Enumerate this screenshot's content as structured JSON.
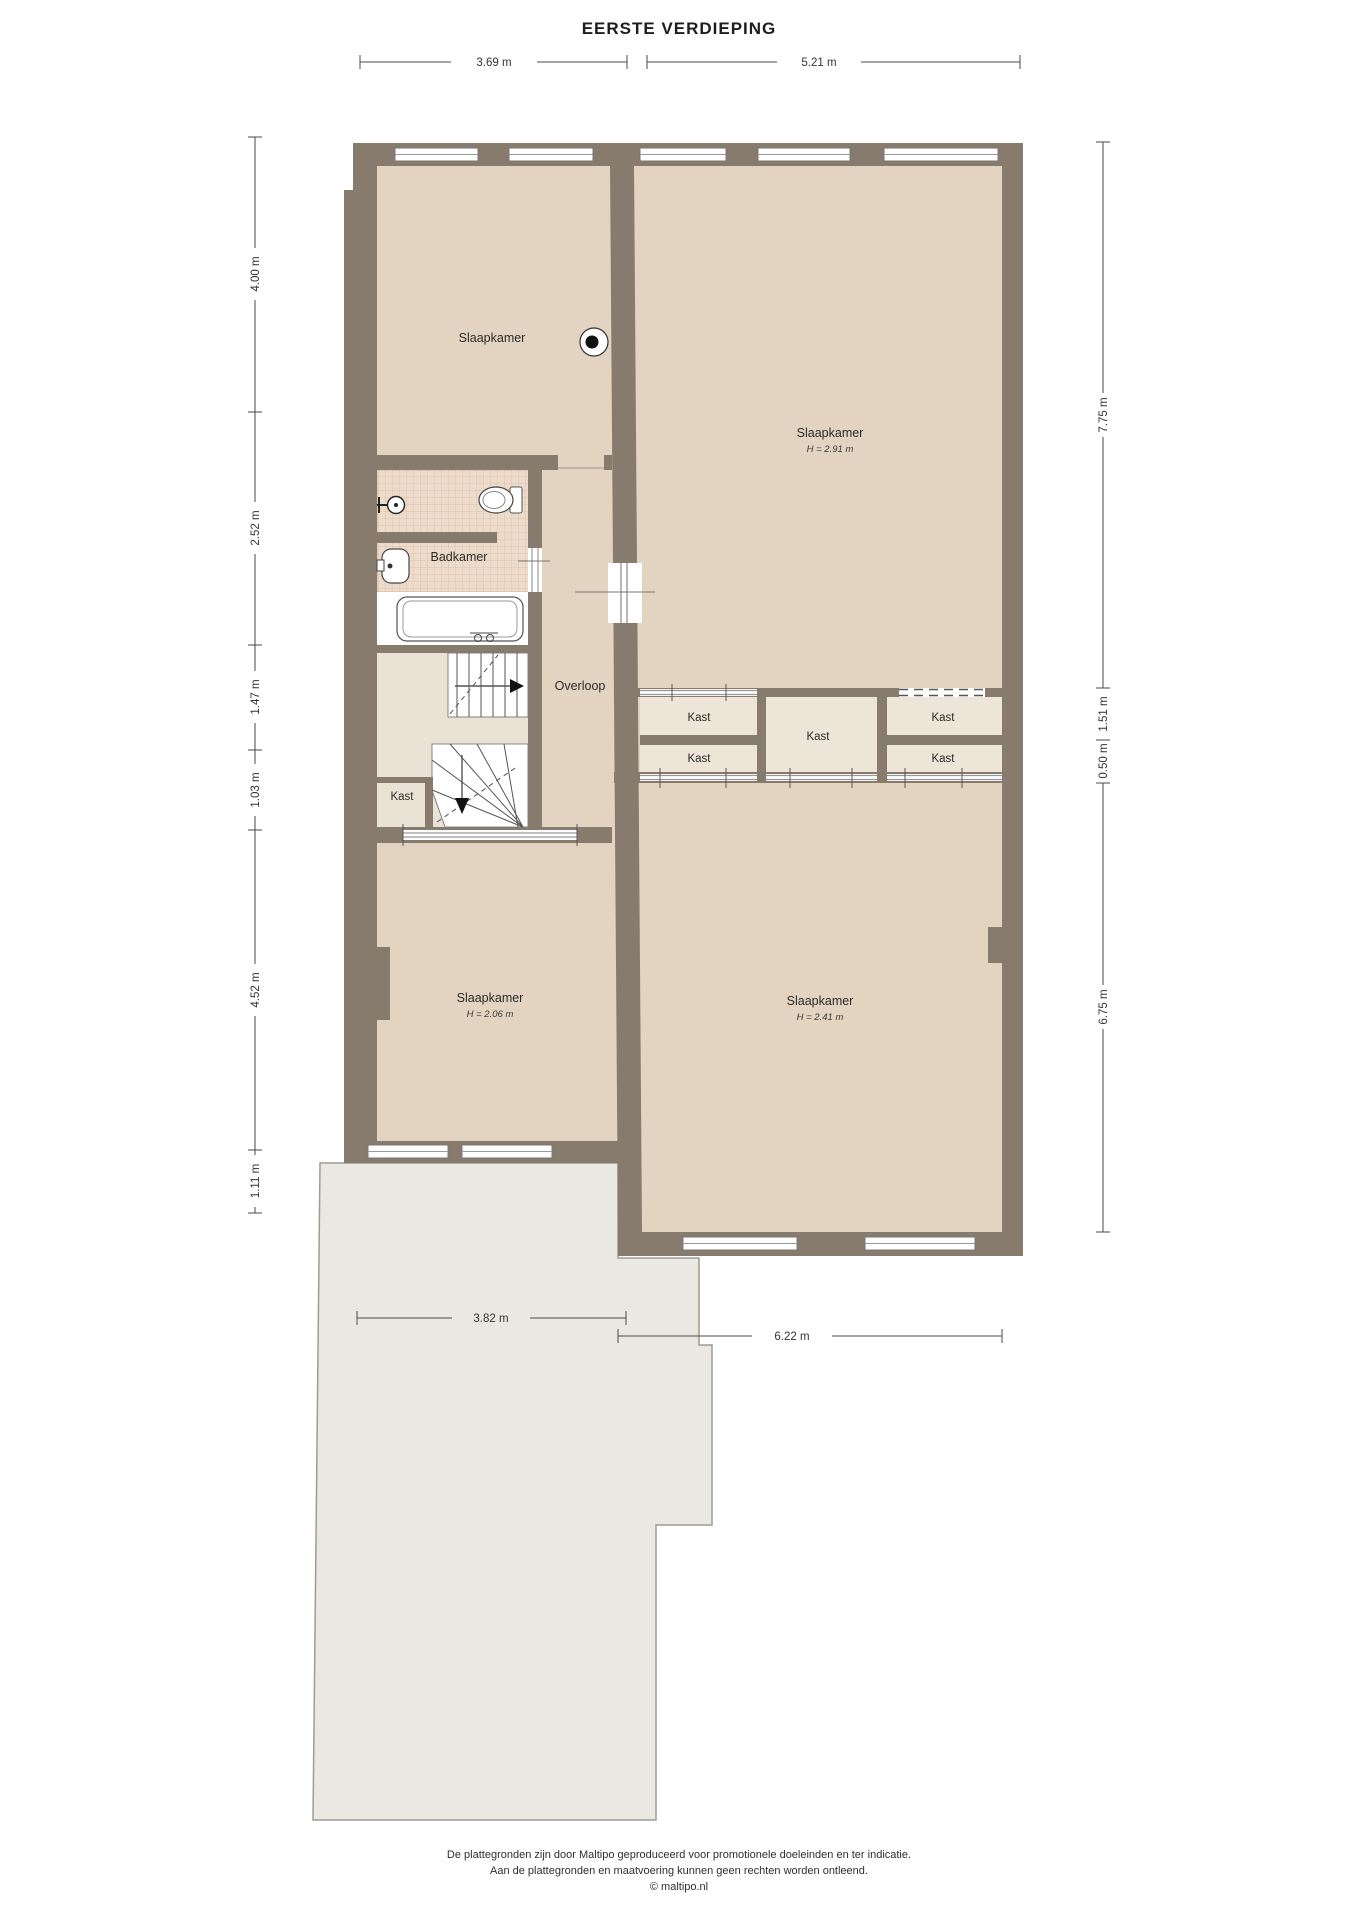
{
  "title": "EERSTE VERDIEPING",
  "rooms": {
    "bedroom_nw": {
      "label": "Slaapkamer"
    },
    "bedroom_ne": {
      "label": "Slaapkamer",
      "ceiling_height": "H = 2.91 m"
    },
    "bathroom": {
      "label": "Badkamer"
    },
    "hallway": {
      "label": "Overloop"
    },
    "bedroom_sw": {
      "label": "Slaapkamer",
      "ceiling_height": "H = 2.06 m"
    },
    "bedroom_se": {
      "label": "Slaapkamer",
      "ceiling_height": "H = 2.41 m"
    },
    "closets": [
      "Kast",
      "Kast",
      "Kast",
      "Kast",
      "Kast",
      "Kast"
    ]
  },
  "dimensions": {
    "top": [
      "3.69 m",
      "5.21 m"
    ],
    "left": [
      "4.00 m",
      "2.52 m",
      "1.47 m",
      "1.03 m",
      "4.52 m",
      "1.11 m"
    ],
    "right": [
      "7.75 m",
      "1.51 m",
      "0.50 m",
      "6.75 m"
    ],
    "bottom": [
      "3.82 m",
      "6.22 m"
    ]
  },
  "footer": {
    "line1": "De plattegronden zijn door Maltipo geproduceerd voor promotionele doeleinden en ter indicatie.",
    "line2": "Aan de plattegronden en maatvoering kunnen geen rechten worden ontleend.",
    "line3": "© maltipo.nl"
  },
  "colors": {
    "wall": "#877B6E",
    "floor": "#E2D4C0",
    "closet_floor": "#EDE6D8",
    "tile": "#EDDCCB",
    "extension": "#EAE8E2"
  }
}
